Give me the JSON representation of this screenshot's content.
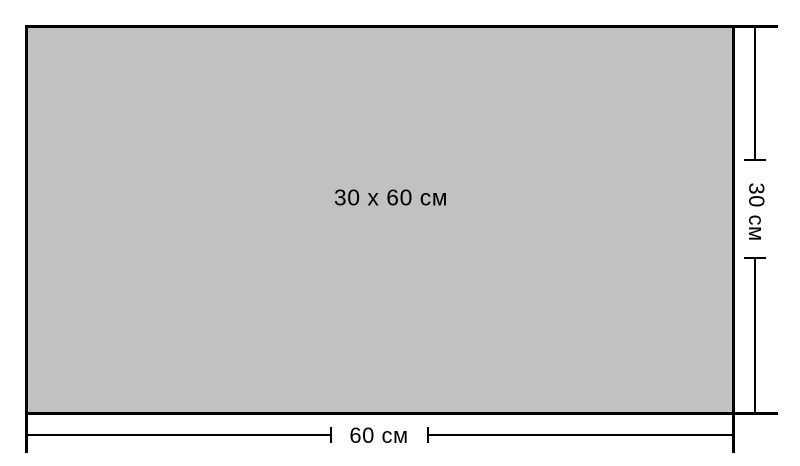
{
  "diagram": {
    "background_color": "#ffffff",
    "line_color": "#000000",
    "rectangle": {
      "label": "30 x 60 см",
      "fill_color": "#c1c1c1"
    },
    "dimensions": {
      "height_label": "30 см",
      "width_label": "60 см"
    }
  }
}
